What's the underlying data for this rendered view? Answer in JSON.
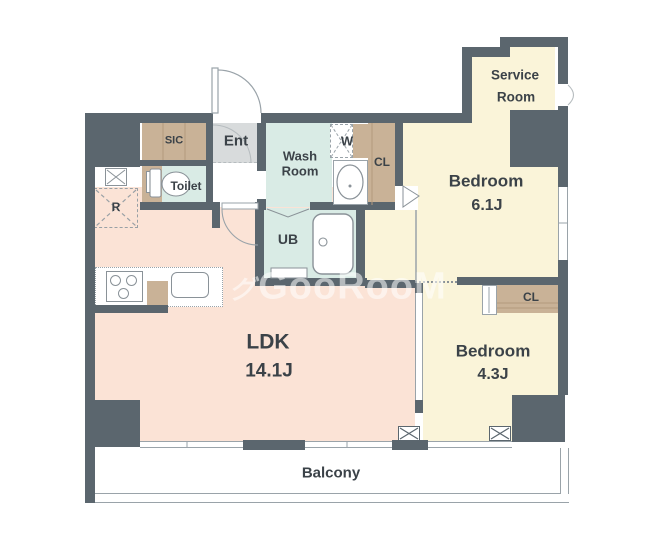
{
  "plan_title": "apartment-floor-plan",
  "watermark": {
    "prefix": "グ",
    "text": "GooRooM"
  },
  "rooms": {
    "ldk": {
      "name": "LDK",
      "size": "14.1J"
    },
    "bedroom_a": {
      "name": "Bedroom",
      "size": "6.1J"
    },
    "bedroom_b": {
      "name": "Bedroom",
      "size": "4.3J"
    },
    "service": {
      "line1": "Service",
      "line2": "Room"
    },
    "washroom": {
      "line1": "Wash",
      "line2": "Room"
    },
    "toilet": {
      "label": "Toilet"
    },
    "entrance": {
      "label": "Ent"
    },
    "shoe_closet": {
      "label": "SIC"
    },
    "unit_bath": {
      "label": "UB"
    },
    "balcony": {
      "label": "Balcony"
    },
    "washer": {
      "label": "W"
    },
    "refrigerator": {
      "label": "R"
    },
    "closet_a": {
      "label": "CL"
    },
    "closet_b": {
      "label": "CL"
    }
  },
  "colors": {
    "wall": "#5b666e",
    "ldk_floor": "#fbe3d6",
    "bedroom_floor": "#faf4d9",
    "wet_area_floor": "#d9ebe5",
    "closet": "#c9b297",
    "entrance_tile": "#d8dbdc"
  }
}
